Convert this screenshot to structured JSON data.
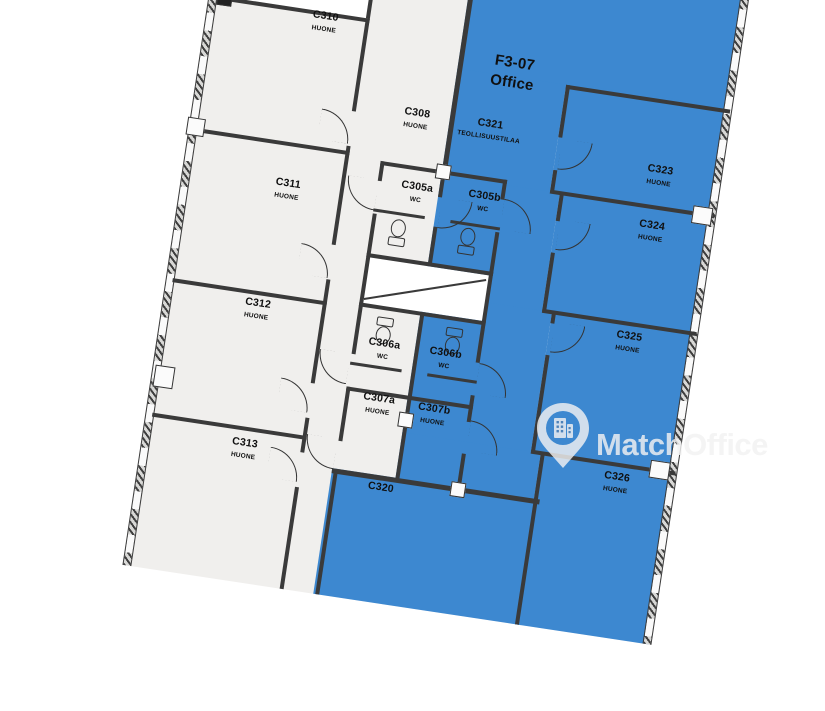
{
  "plan": {
    "highlight": {
      "code": "F3-07",
      "label": "Office",
      "color": "#3d88d0"
    },
    "rooms": [
      {
        "code": "C310",
        "type": "HUONE",
        "highlighted": false
      },
      {
        "code": "C311",
        "type": "HUONE",
        "highlighted": false
      },
      {
        "code": "C312",
        "type": "HUONE",
        "highlighted": false
      },
      {
        "code": "C313",
        "type": "HUONE",
        "highlighted": false
      },
      {
        "code": "C308",
        "type": "HUONE",
        "highlighted": false
      },
      {
        "code": "C305a",
        "type": "WC",
        "highlighted": false
      },
      {
        "code": "C305b",
        "type": "WC",
        "highlighted": true
      },
      {
        "code": "C306a",
        "type": "WC",
        "highlighted": false
      },
      {
        "code": "C306b",
        "type": "WC",
        "highlighted": true
      },
      {
        "code": "C307a",
        "type": "HUONE",
        "highlighted": false
      },
      {
        "code": "C307b",
        "type": "HUONE",
        "highlighted": true
      },
      {
        "code": "C320",
        "type": "",
        "highlighted": true
      },
      {
        "code": "C321",
        "type": "TEOLLISUUSTILAA",
        "highlighted": true
      },
      {
        "code": "C323",
        "type": "HUONE",
        "highlighted": true
      },
      {
        "code": "C324",
        "type": "HUONE",
        "highlighted": true
      },
      {
        "code": "C325",
        "type": "HUONE",
        "highlighted": true
      },
      {
        "code": "C326",
        "type": "HUONE",
        "highlighted": true
      }
    ],
    "colors": {
      "room_fill": "#f0efed",
      "wall": "#3a3a3a",
      "shaft": "#ffffff"
    }
  },
  "watermark": {
    "brand": "MatchOffice",
    "icon": "map-pin-building-icon"
  }
}
